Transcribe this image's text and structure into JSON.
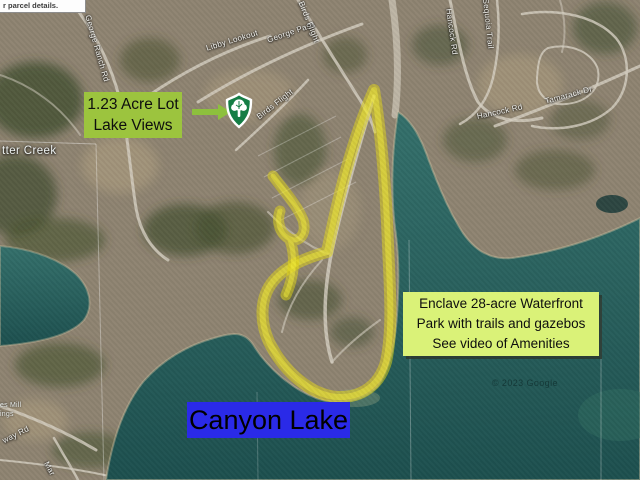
{
  "window": {
    "width": 640,
    "height": 480,
    "kind": "satellite-map-listing-screenshot"
  },
  "notice": {
    "text": "r parcel details."
  },
  "callouts": {
    "lot": {
      "line1": "1.23 Acre Lot",
      "line2": "Lake Views",
      "bg": "#9cc43e"
    },
    "enclave": {
      "line1": "Enclave 28-acre Waterfront",
      "line2": "Park with trails and gazebos",
      "line3": "See video of Amenities",
      "bg": "#daf278"
    },
    "lake": {
      "text": "Canyon Lake",
      "bg": "#2a2ae8"
    }
  },
  "marker": {
    "name": "green-tree-shield-marker",
    "color": "#157d45"
  },
  "highlight": {
    "color": "#e6da12",
    "style": "hand-drawn highlighter outline around waterfront park"
  },
  "labels": {
    "places": {
      "creek": "tter Creek",
      "mill_line1": "es Mill",
      "mill_line2": "ings"
    },
    "roads": {
      "george_ranch": "George Ranch Rd",
      "libby_lookout": "Libby Lookout",
      "george_pass": "George Pass",
      "birds_flight_top": "Birds Flight",
      "birds_flight_lower": "Birds Flight",
      "hancock_upper": "Hancock Rd",
      "hancock_lower": "Hancock Rd",
      "sequoia": "Sequoia Trail",
      "tamarack": "Tamarack Dr",
      "way_rd": "way Rd",
      "mar": "Mar"
    },
    "attribution": "© 2023 Google"
  },
  "colors": {
    "water": "#2a615f",
    "land": "#8f8472",
    "roads": "#d6cfc2"
  }
}
